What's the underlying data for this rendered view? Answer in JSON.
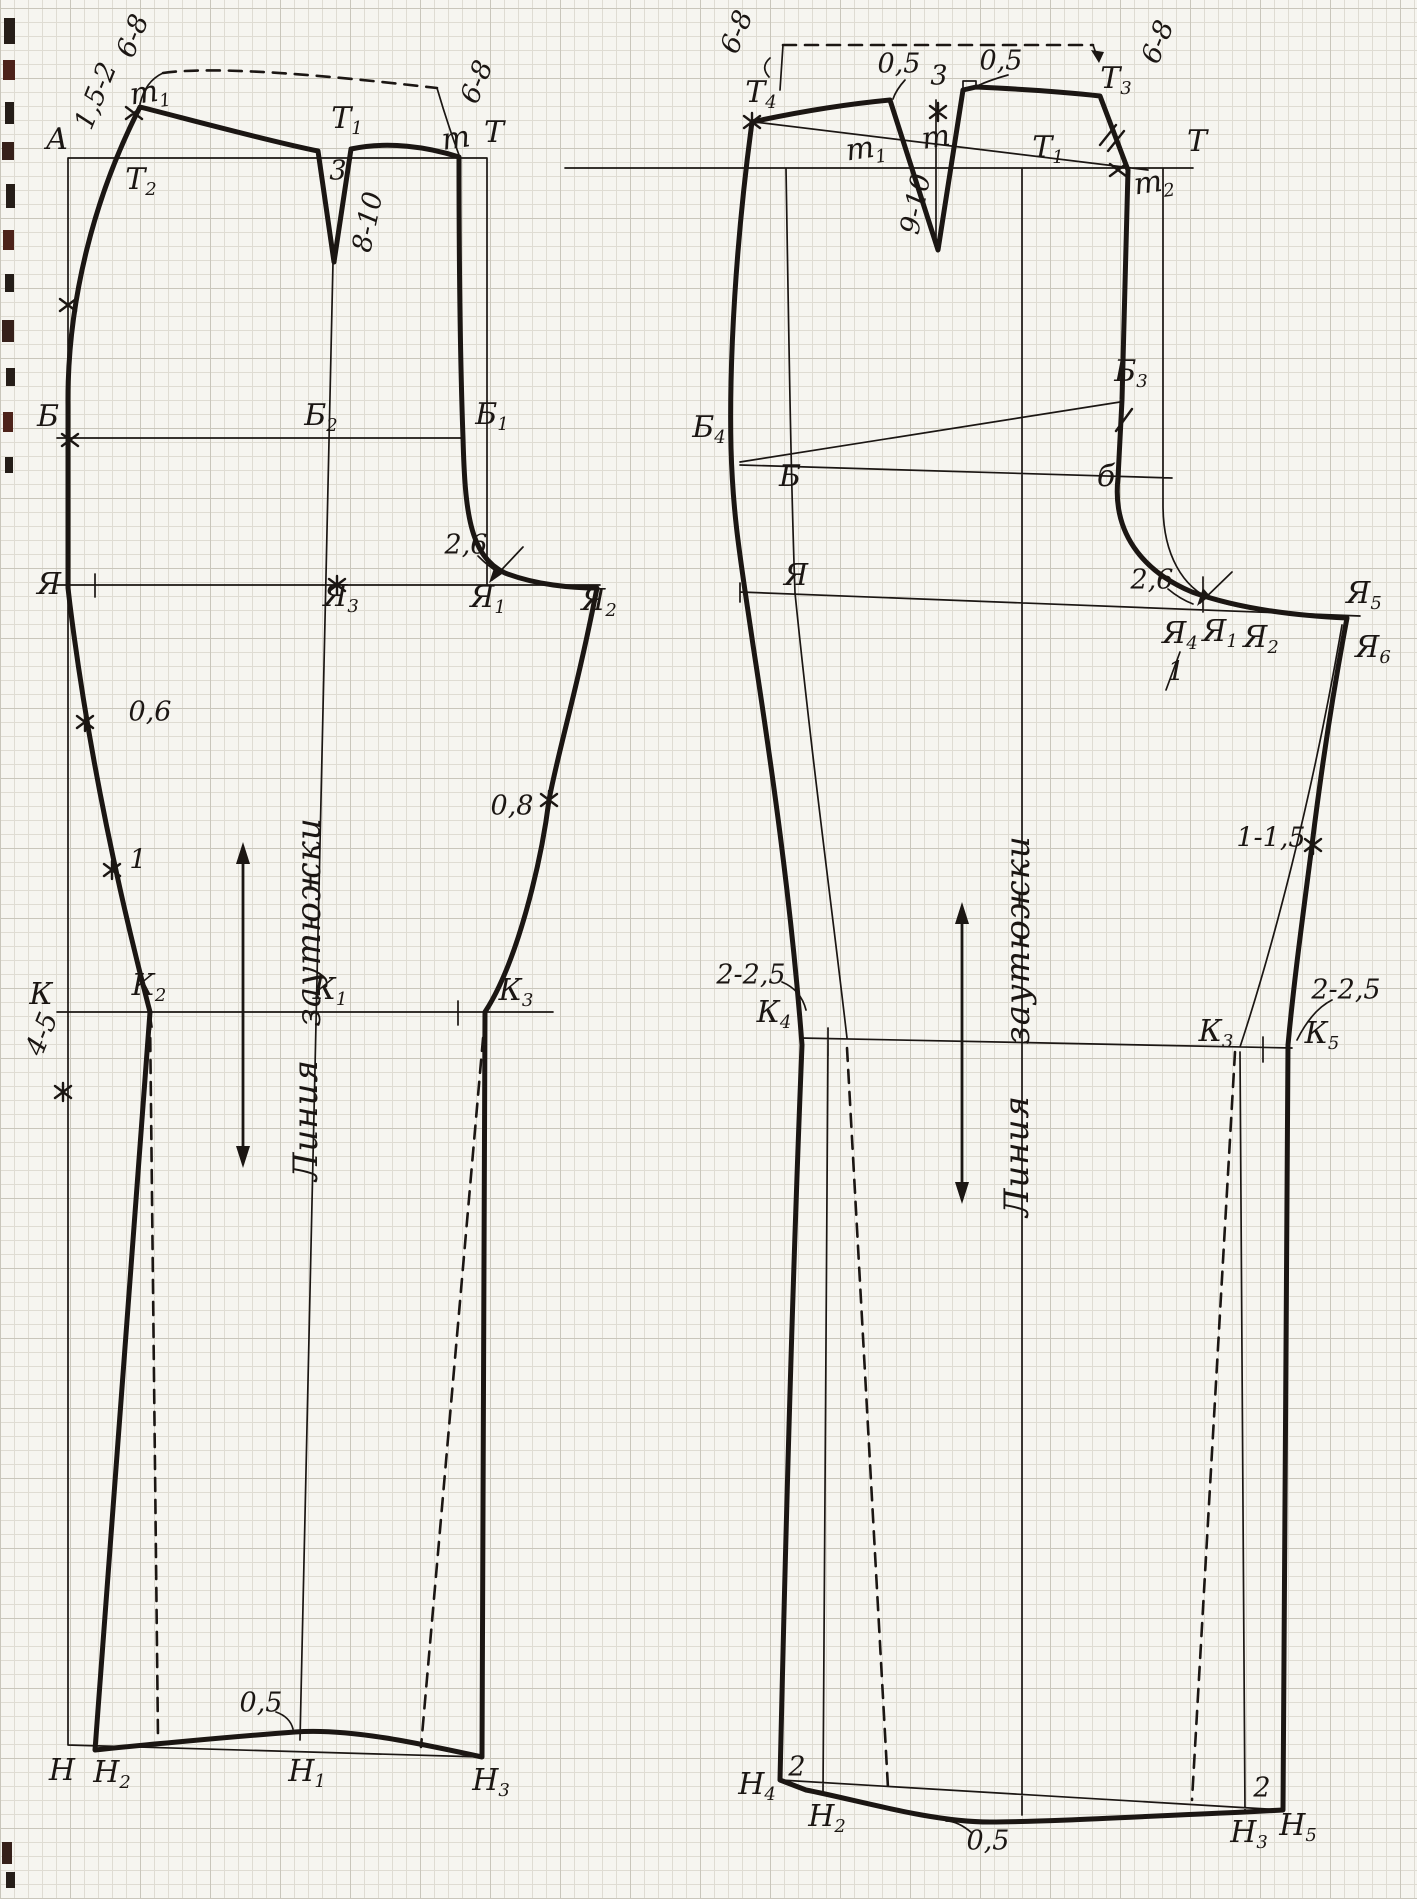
{
  "page": {
    "kind": "scanned sewing-pattern drafting diagram on graph paper",
    "paper_color": "#f6f5f0",
    "ink_color": "#1b1613",
    "grid_minor_color": "#dfdcd3",
    "grid_major_color": "#c9c6bb"
  },
  "symbols": {
    "grainline_arrow": "double-headed-vertical-arrow",
    "point_marks": "x-and-asterisk-marks",
    "dashed_lines": "auxiliary-fold-lines"
  },
  "front_piece": {
    "name": "trouser front half pattern",
    "grainline_text_top": "заутюжки",
    "grainline_text_bottom": "Линия",
    "labels": [
      {
        "text": "6-8",
        "x": 133,
        "y": 36,
        "rot": -68,
        "num": true
      },
      {
        "text": "1,5-2",
        "x": 96,
        "y": 96,
        "rot": -68,
        "num": true
      },
      {
        "text": "m1",
        "sub": true,
        "x": 150,
        "y": 95,
        "rot": -8
      },
      {
        "text": "А",
        "x": 57,
        "y": 140
      },
      {
        "text": "Т2",
        "sub": true,
        "x": 141,
        "y": 182
      },
      {
        "text": "Т1",
        "sub": true,
        "x": 347,
        "y": 121
      },
      {
        "text": "3",
        "x": 338,
        "y": 171,
        "num": true
      },
      {
        "text": "8-10",
        "x": 368,
        "y": 222,
        "rot": -78,
        "num": true
      },
      {
        "text": "m",
        "x": 456,
        "y": 139,
        "rot": -8
      },
      {
        "text": "Т",
        "x": 494,
        "y": 133
      },
      {
        "text": "6-8",
        "x": 477,
        "y": 82,
        "rot": -68,
        "num": true
      },
      {
        "text": "Б",
        "x": 48,
        "y": 417
      },
      {
        "text": "Б2",
        "sub": true,
        "x": 321,
        "y": 418
      },
      {
        "text": "Б1",
        "sub": true,
        "x": 492,
        "y": 417
      },
      {
        "text": "2,6",
        "x": 466,
        "y": 545,
        "num": true
      },
      {
        "text": "Я",
        "x": 49,
        "y": 585
      },
      {
        "text": "Я3",
        "sub": true,
        "x": 341,
        "y": 599
      },
      {
        "text": "Я1",
        "sub": true,
        "x": 488,
        "y": 600
      },
      {
        "text": "Я2",
        "sub": true,
        "x": 599,
        "y": 603
      },
      {
        "text": "0,6",
        "x": 150,
        "y": 712,
        "num": true
      },
      {
        "text": "1",
        "x": 138,
        "y": 860,
        "num": true
      },
      {
        "text": "0,8",
        "x": 512,
        "y": 806,
        "num": true
      },
      {
        "text": "заутюжки",
        "x": 309,
        "y": 922,
        "rot": -90,
        "cls": "vtext"
      },
      {
        "text": "Линия",
        "x": 306,
        "y": 1120,
        "rot": -90,
        "cls": "vtext"
      },
      {
        "text": "К",
        "x": 41,
        "y": 995
      },
      {
        "text": "К2",
        "sub": true,
        "x": 149,
        "y": 988
      },
      {
        "text": "К1",
        "sub": true,
        "x": 330,
        "y": 992
      },
      {
        "text": "К3",
        "sub": true,
        "x": 516,
        "y": 993
      },
      {
        "text": "4-5",
        "x": 42,
        "y": 1034,
        "rot": -68,
        "num": true
      },
      {
        "text": "0,5",
        "x": 261,
        "y": 1703,
        "num": true
      },
      {
        "text": "Н",
        "x": 62,
        "y": 1771
      },
      {
        "text": "Н2",
        "sub": true,
        "x": 112,
        "y": 1775
      },
      {
        "text": "Н1",
        "sub": true,
        "x": 307,
        "y": 1774
      },
      {
        "text": "Н3",
        "sub": true,
        "x": 491,
        "y": 1783
      }
    ]
  },
  "back_piece": {
    "name": "trouser back half pattern",
    "grainline_text_top": "заутюжки",
    "grainline_text_bottom": "Линия",
    "labels": [
      {
        "text": "6-8",
        "x": 737,
        "y": 32,
        "rot": -68,
        "num": true
      },
      {
        "text": "Т4",
        "sub": true,
        "x": 761,
        "y": 95
      },
      {
        "text": "0,5",
        "x": 899,
        "y": 64,
        "num": true
      },
      {
        "text": "3",
        "x": 939,
        "y": 76,
        "num": true
      },
      {
        "text": "0,5",
        "x": 1001,
        "y": 61,
        "num": true
      },
      {
        "text": "Т3",
        "sub": true,
        "x": 1116,
        "y": 81
      },
      {
        "text": "6-8",
        "x": 1158,
        "y": 42,
        "rot": -68,
        "num": true
      },
      {
        "text": "Т",
        "x": 1197,
        "y": 142
      },
      {
        "text": "m1",
        "sub": true,
        "x": 866,
        "y": 151,
        "rot": -8
      },
      {
        "text": "m",
        "x": 936,
        "y": 138,
        "rot": -8
      },
      {
        "text": "Т1",
        "sub": true,
        "x": 1048,
        "y": 150
      },
      {
        "text": "m2",
        "sub": true,
        "x": 1154,
        "y": 185,
        "rot": -8
      },
      {
        "text": "9-10",
        "x": 916,
        "y": 204,
        "rot": -78,
        "num": true
      },
      {
        "text": "Б4",
        "sub": true,
        "x": 709,
        "y": 430
      },
      {
        "text": "Б",
        "x": 790,
        "y": 477
      },
      {
        "text": "Б3",
        "sub": true,
        "x": 1131,
        "y": 374
      },
      {
        "text": "б",
        "x": 1106,
        "y": 477
      },
      {
        "text": "Я",
        "x": 796,
        "y": 576
      },
      {
        "text": "2,6",
        "x": 1152,
        "y": 580,
        "num": true
      },
      {
        "text": "Я4",
        "sub": true,
        "x": 1180,
        "y": 636
      },
      {
        "text": "Я1",
        "sub": true,
        "x": 1220,
        "y": 634
      },
      {
        "text": "Я2",
        "sub": true,
        "x": 1261,
        "y": 640
      },
      {
        "text": "Я5",
        "sub": true,
        "x": 1364,
        "y": 596
      },
      {
        "text": "Я6",
        "sub": true,
        "x": 1373,
        "y": 650
      },
      {
        "text": "1",
        "x": 1176,
        "y": 672,
        "num": true
      },
      {
        "text": "1-1,5",
        "x": 1271,
        "y": 838,
        "num": true
      },
      {
        "text": "заутюжки",
        "x": 1018,
        "y": 940,
        "rot": -90,
        "cls": "vtext"
      },
      {
        "text": "Линия",
        "x": 1017,
        "y": 1156,
        "rot": -90,
        "cls": "vtext"
      },
      {
        "text": "2-2,5",
        "x": 751,
        "y": 975,
        "num": true
      },
      {
        "text": "К4",
        "sub": true,
        "x": 774,
        "y": 1015
      },
      {
        "text": "К3",
        "sub": true,
        "x": 1216,
        "y": 1034
      },
      {
        "text": "К5",
        "sub": true,
        "x": 1322,
        "y": 1036
      },
      {
        "text": "2-2,5",
        "x": 1346,
        "y": 990,
        "num": true
      },
      {
        "text": "Н4",
        "sub": true,
        "x": 757,
        "y": 1787
      },
      {
        "text": "2",
        "x": 797,
        "y": 1767,
        "num": true
      },
      {
        "text": "Н2",
        "sub": true,
        "x": 827,
        "y": 1819
      },
      {
        "text": "0,5",
        "x": 988,
        "y": 1841,
        "num": true
      },
      {
        "text": "Н3",
        "sub": true,
        "x": 1249,
        "y": 1835
      },
      {
        "text": "2",
        "x": 1262,
        "y": 1788,
        "num": true
      },
      {
        "text": "Н5",
        "sub": true,
        "x": 1298,
        "y": 1828
      }
    ]
  }
}
